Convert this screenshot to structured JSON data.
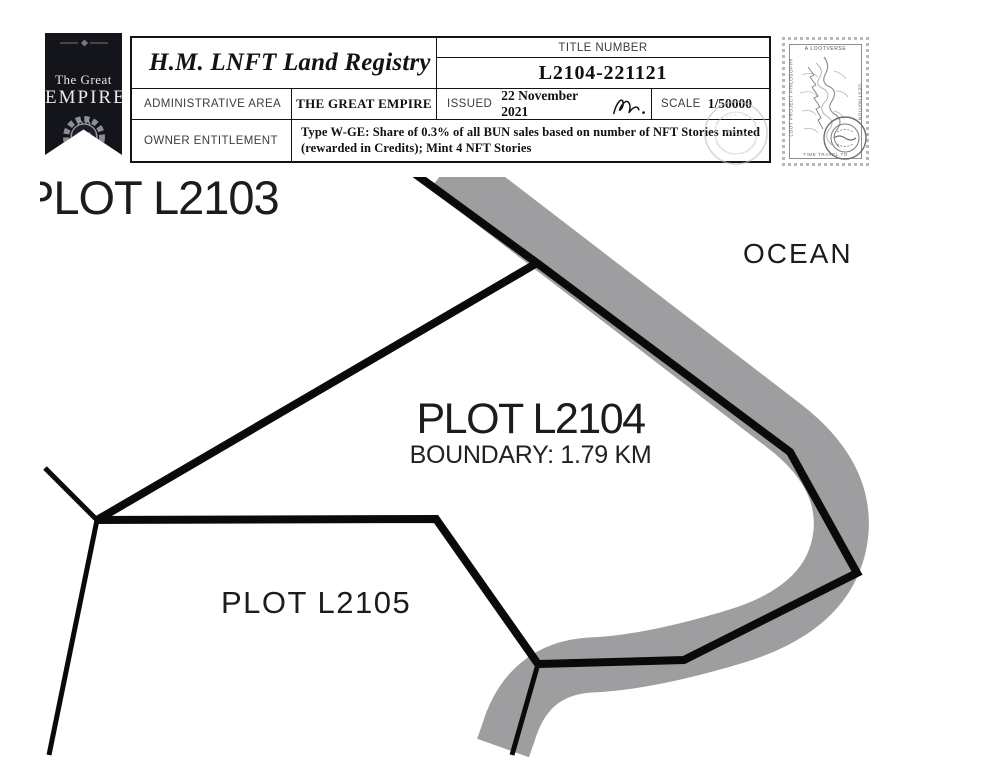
{
  "header": {
    "badge": {
      "line1": "The Great",
      "line2": "EMPIRE"
    },
    "registry_title": "H.M. LNFT Land Registry",
    "title_number_label": "TITLE NUMBER",
    "title_number": "L2104-221121",
    "admin_area_label": "ADMINISTRATIVE AREA",
    "admin_area_value": "THE GREAT EMPIRE",
    "issued_label": "ISSUED",
    "issued_date": "22 November 2021",
    "scale_label": "SCALE",
    "scale_value": "1/50000",
    "owner_entitlement_label": "OWNER ENTITLEMENT",
    "owner_entitlement_line1": "Type W-GE: Share of 0.3% of all BUN sales based on number of NFT Stories minted",
    "owner_entitlement_line2": "(rewarded in Credits); Mint 4 NFT Stories"
  },
  "postage_stamp": {
    "top_label": "A LOOTVERSE",
    "left_label": "LOOT PROJECT PHILOSOPHY",
    "right_label": "DESTINATION",
    "bottom_label": "TIME TRAVEL TO"
  },
  "map": {
    "plot_top_left": "PLOT L2103",
    "ocean_label": "OCEAN",
    "plot_center": "PLOT L2104",
    "plot_center_boundary": "BOUNDARY: 1.79 KM",
    "plot_bottom": "PLOT L2105"
  },
  "colors": {
    "river_band": "#9e9ea0",
    "plot_boundary": "#0a0a0a",
    "badge_background": "#14141b",
    "map_label": "#1c1c1c"
  }
}
